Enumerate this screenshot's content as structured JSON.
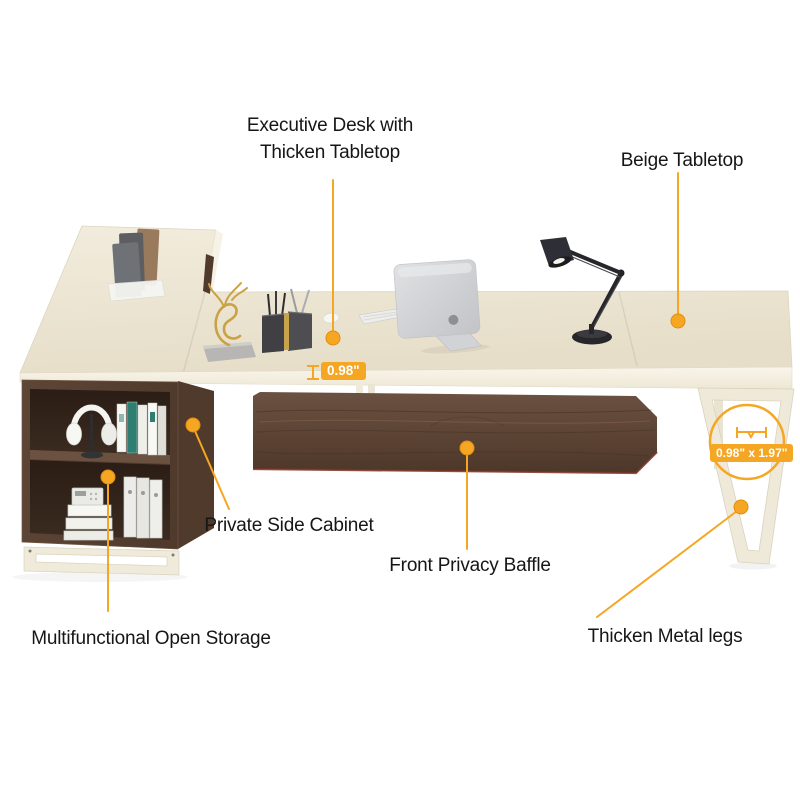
{
  "meta": {
    "type": "furniture-product-infographic",
    "background": "#FFFFFF"
  },
  "colors": {
    "accent": "#F5A623",
    "accent_deep": "#E08E0B",
    "label_text": "#161616",
    "badge_text": "#FFFFFF",
    "tabletop_beige": "#EFE8D8",
    "walnut": "#5A4232",
    "metal_leg_cream": "#EDE8D9"
  },
  "callouts": {
    "executive_desk": {
      "line1": "Executive Desk with",
      "line2": "Thicken Tabletop"
    },
    "beige_tabletop": {
      "label": "Beige Tabletop"
    },
    "private_side_cabinet": {
      "label": "Private Side Cabinet"
    },
    "front_privacy_baffle": {
      "label": "Front Privacy Baffle"
    },
    "multifunctional_open_storage": {
      "label": "Multifunctional Open Storage"
    },
    "thicken_metal_legs": {
      "label": "Thicken Metal legs"
    }
  },
  "measurements": {
    "tabletop_thickness": "0.98\"",
    "leg_profile": "0.98\" x 1.97\""
  }
}
